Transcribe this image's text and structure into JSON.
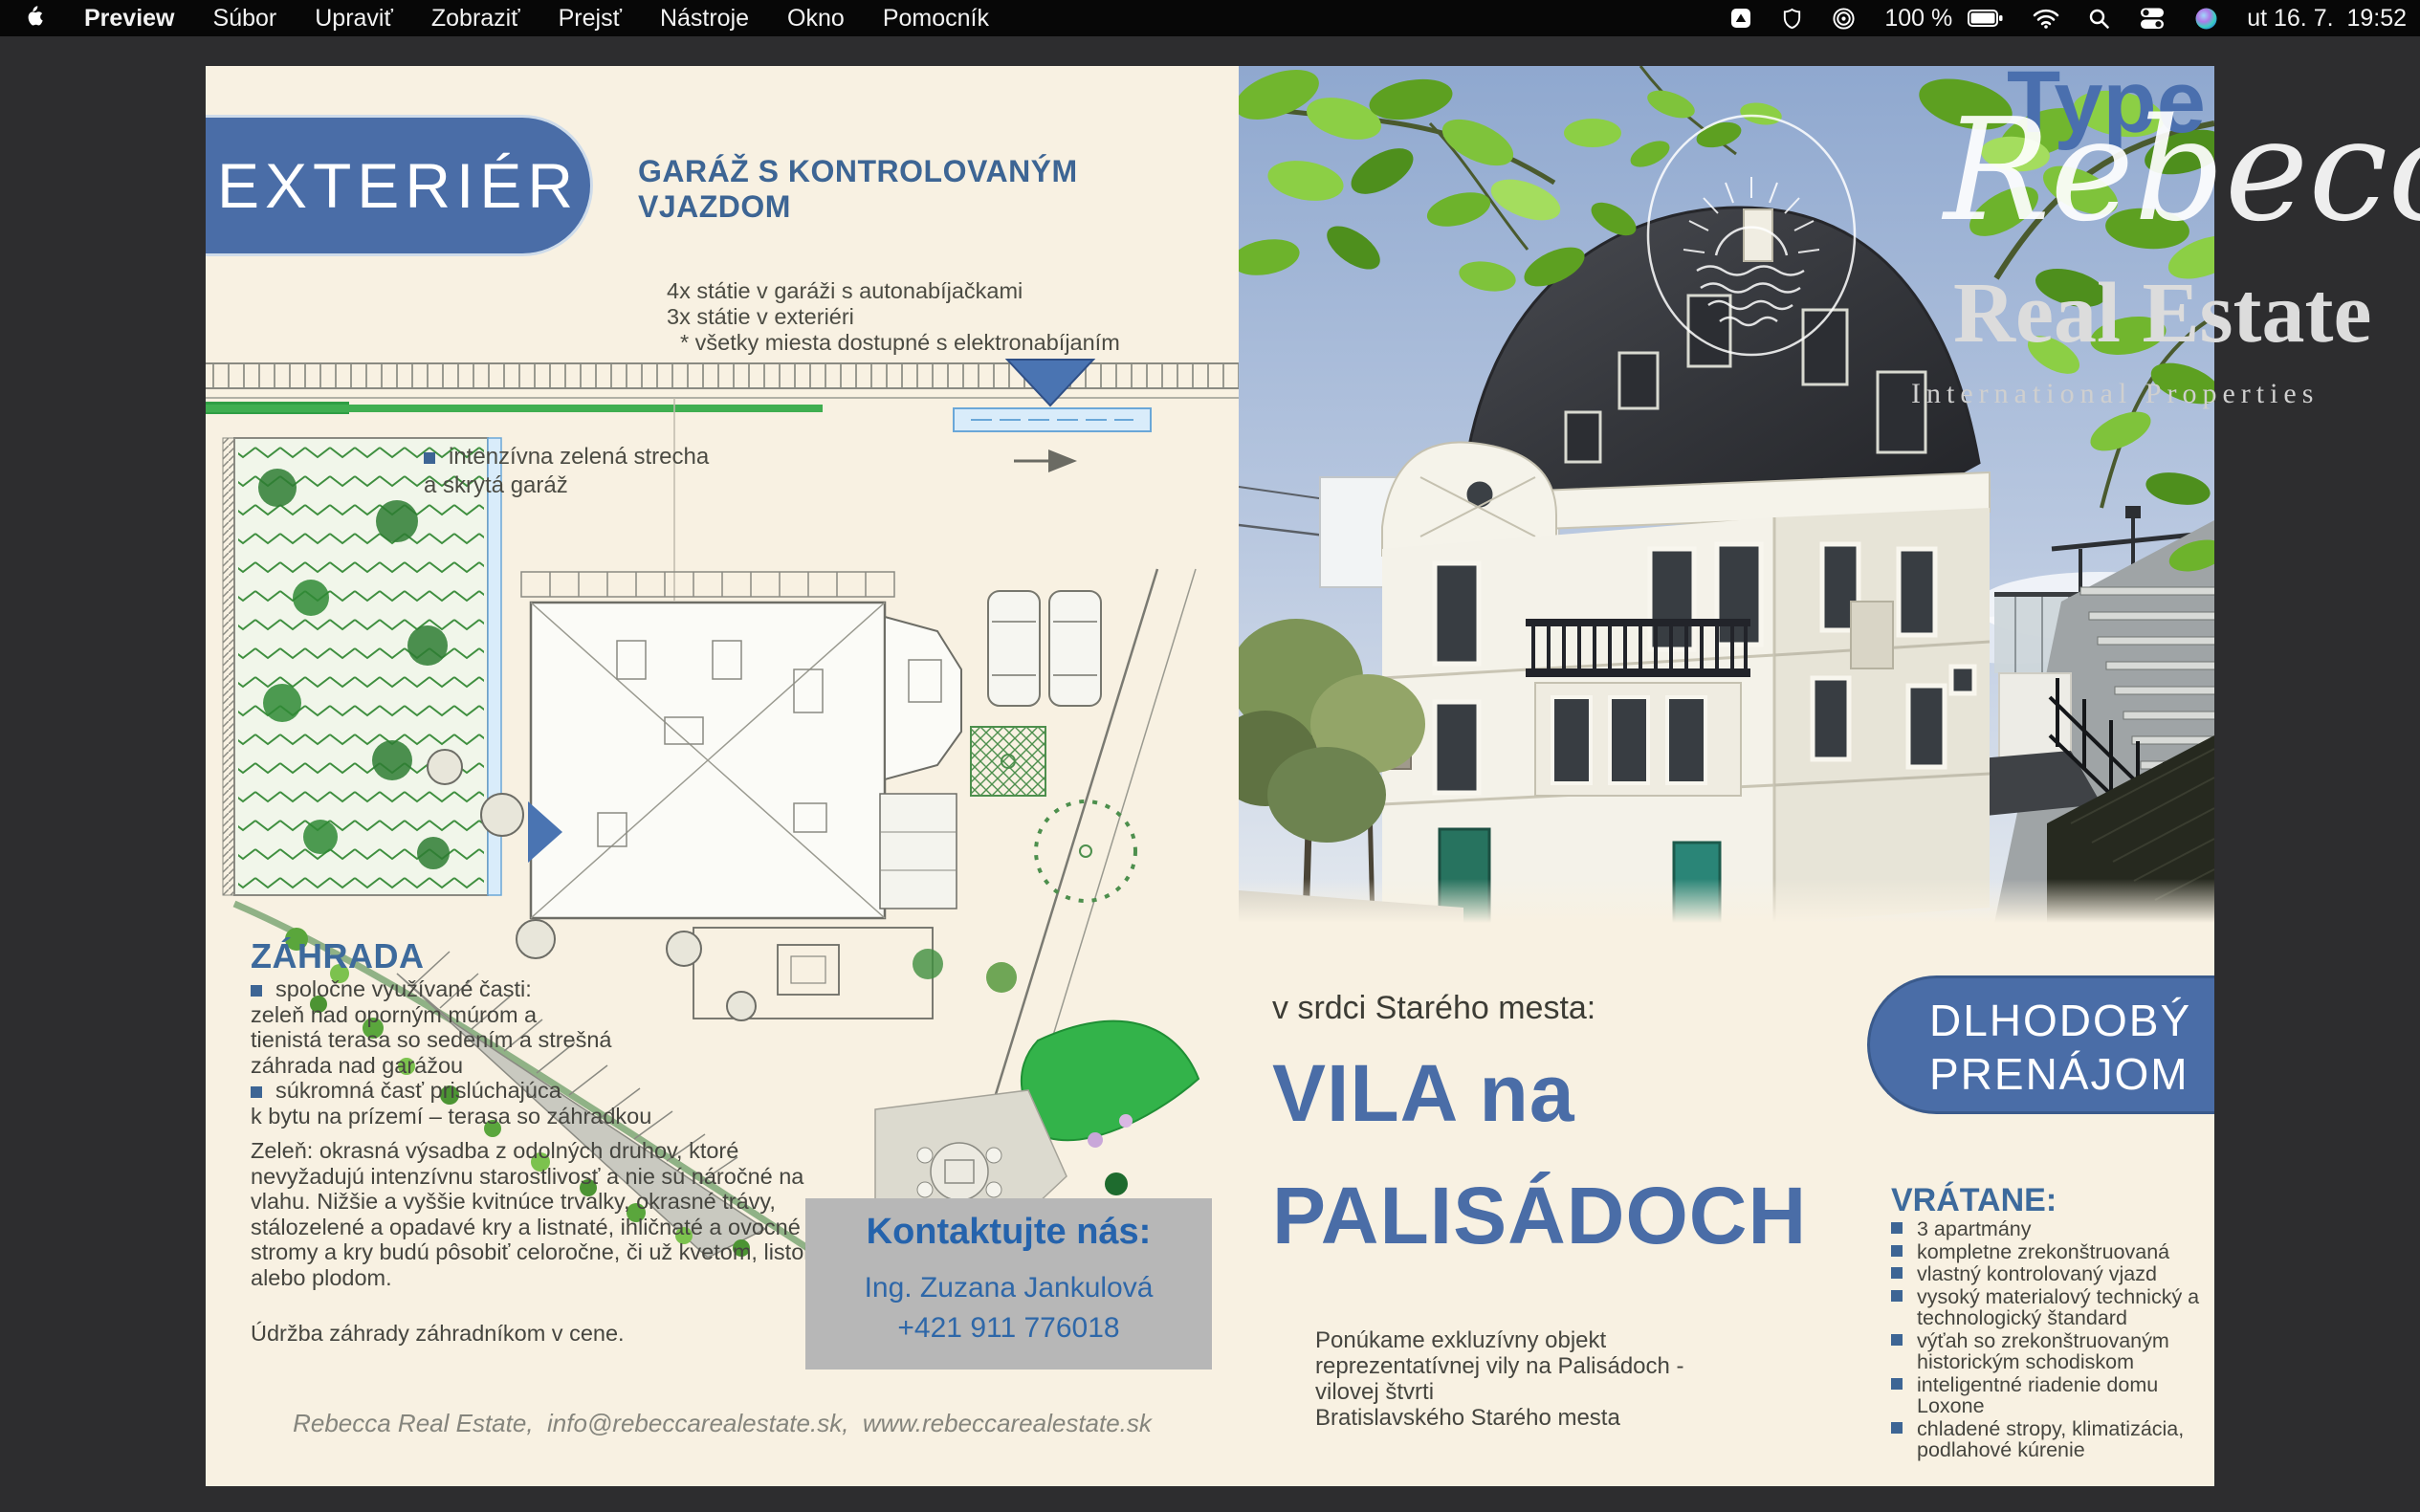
{
  "menu_bar": {
    "items": [
      "Preview",
      "Súbor",
      "Upraviť",
      "Zobraziť",
      "Prejsť",
      "Nástroje",
      "Okno",
      "Pomocník"
    ],
    "status": {
      "battery_percent": "100 %",
      "clock": "ut 16. 7.  19:52"
    }
  },
  "left_page": {
    "section_badge": "EXTERIÉR",
    "garage_heading_line1": "GARÁŽ S KONTROLOVANÝM",
    "garage_heading_line2": "VJAZDOM",
    "garage_items": [
      "4x státie v garáži s autonabíjačkami",
      "3x státie v exteriéri",
      "* všetky miesta dostupné s elektronabíjaním"
    ],
    "roof_note_line1": "intenzívna zelená strecha",
    "roof_note_line2": "a skrytá garáž",
    "garden_heading": "ZÁHRADA",
    "garden_lines": [
      "spoločne využívané časti:",
      "zeleň nad oporným múrom a",
      "tienistá terasa so sedením a strešná",
      "záhrada nad garážou",
      "súkromná časť prislúchajúca",
      "k bytu na prízemí – terasa so záhradkou"
    ],
    "greenery_paragraph": "Zeleň: okrasná výsadba z odolných druhov, ktoré nevyžadujú intenzívnu starostlivosť a nie sú náročné na vlahu. Nižšie a vyššie kvitnúce trvalky, okrasné trávy, stálozelené a opadavé kry a listnaté, ihličnaté  a ovocné stromy a kry budú pôsobiť celoročne, či už kvetom, listom alebo plodom.",
    "maintenance_note": "Údržba záhrady záhradníkom v cene.",
    "contact_heading": "Kontaktujte nás:",
    "contact_name": "Ing. Zuzana Jankulová",
    "contact_phone": "+421 911 776018",
    "footer": "Rebecca Real Estate,  info@rebeccarealestate.sk,  www.rebeccarealestate.sk"
  },
  "right_page": {
    "intro": "v srdci Starého mesta:",
    "title_line1": "VILA na",
    "title_line2": "PALISÁDOCH",
    "badge_line1": "DLHODOBÝ",
    "badge_line2": "PRENÁJOM",
    "description_lines": [
      "Ponúkame exkluzívny objekt",
      "reprezentatívnej vily na Palisádoch -",
      "vilovej štvrti",
      "Bratislavského Starého mesta"
    ],
    "included_heading": "VRÁTANE:",
    "included_items": [
      "3 apartmány",
      "kompletne zrekonštruovaná",
      "vlastný kontrolovaný vjazd",
      "vysoký materialový technický a technologický štandard",
      "výťah so zrekonštruovaným historickým schodiskom",
      "inteligentné riadenie domu Loxone",
      "chladené stropy, klimatizácia, podlahové kúrenie"
    ]
  },
  "watermark": {
    "type_label": "Type",
    "brand_script": "Rebecca",
    "brand_serif": "Real Estate",
    "tagline": "International Properties"
  },
  "colors": {
    "accent_blue": "#4a6da7",
    "heading_blue": "#3d6594",
    "contact_blue": "#2563ac",
    "page_cream": "#f8f1e2",
    "desktop_gray": "#2d2d2f"
  }
}
